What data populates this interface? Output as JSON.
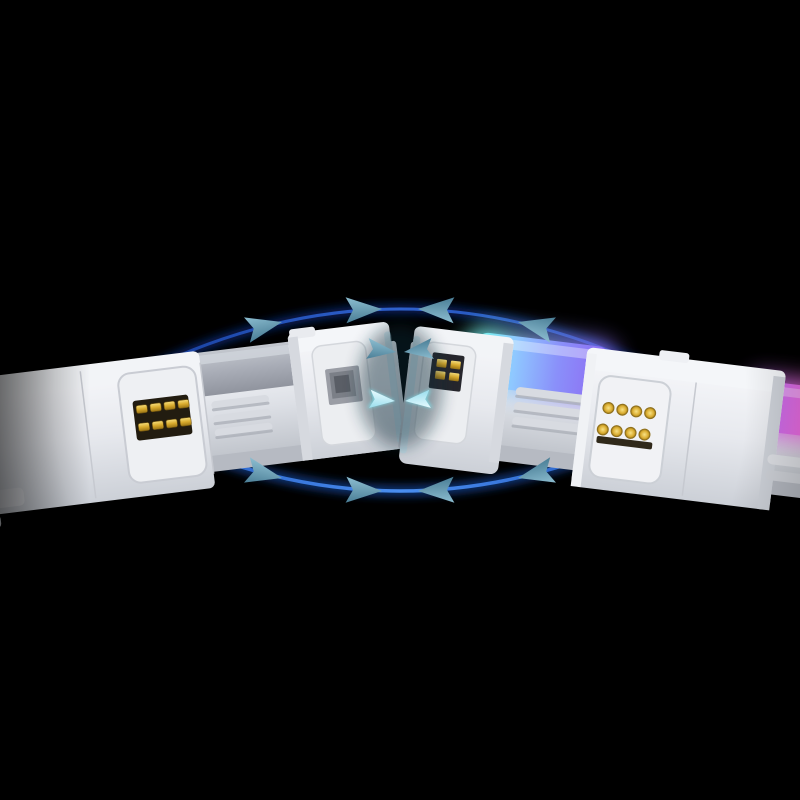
{
  "meta": {
    "description": "Product render on black background: two white magnetic daisy-chain RGB lighting modules aligned end to end, with blue orbital arrows converging toward the center to indicate the magnetic snap connection."
  },
  "palette": {
    "background": "#000000",
    "body_white": "#e8eaee",
    "body_highlight": "#f6f8fa",
    "body_shadow": "#b9bdc6",
    "diffuser_unlit_grey": "#a6abb5",
    "rgb_cyan": "#72f4ea",
    "rgb_blue": "#8fc8ff",
    "rgb_purple": "#8e68f2",
    "rgb_pink": "#f96ce2",
    "contact_gold": "#d9ab2e",
    "orbit_blue_top": "#2f62cf",
    "orbit_blue_bottom": "#4a8ef0",
    "arrow_teal": "#6fa6ba",
    "arrow_ice": "#c8f0f6"
  },
  "left_module": {
    "lit": false,
    "diffuser": "unlit grey",
    "pogo_pin_rows": 2,
    "pogo_pins_per_row": 4
  },
  "right_module": {
    "lit": true,
    "diffuser": "cyan-blue-purple gradient",
    "edge_strip": "pink glow",
    "contact_pad_rows": 2,
    "contact_pads_per_row": 4
  },
  "arrows": {
    "top_arc_arrowheads": 4,
    "bottom_arc_arrowheads": 4,
    "center_arrow_pairs": 2,
    "direction": "converging toward center"
  }
}
